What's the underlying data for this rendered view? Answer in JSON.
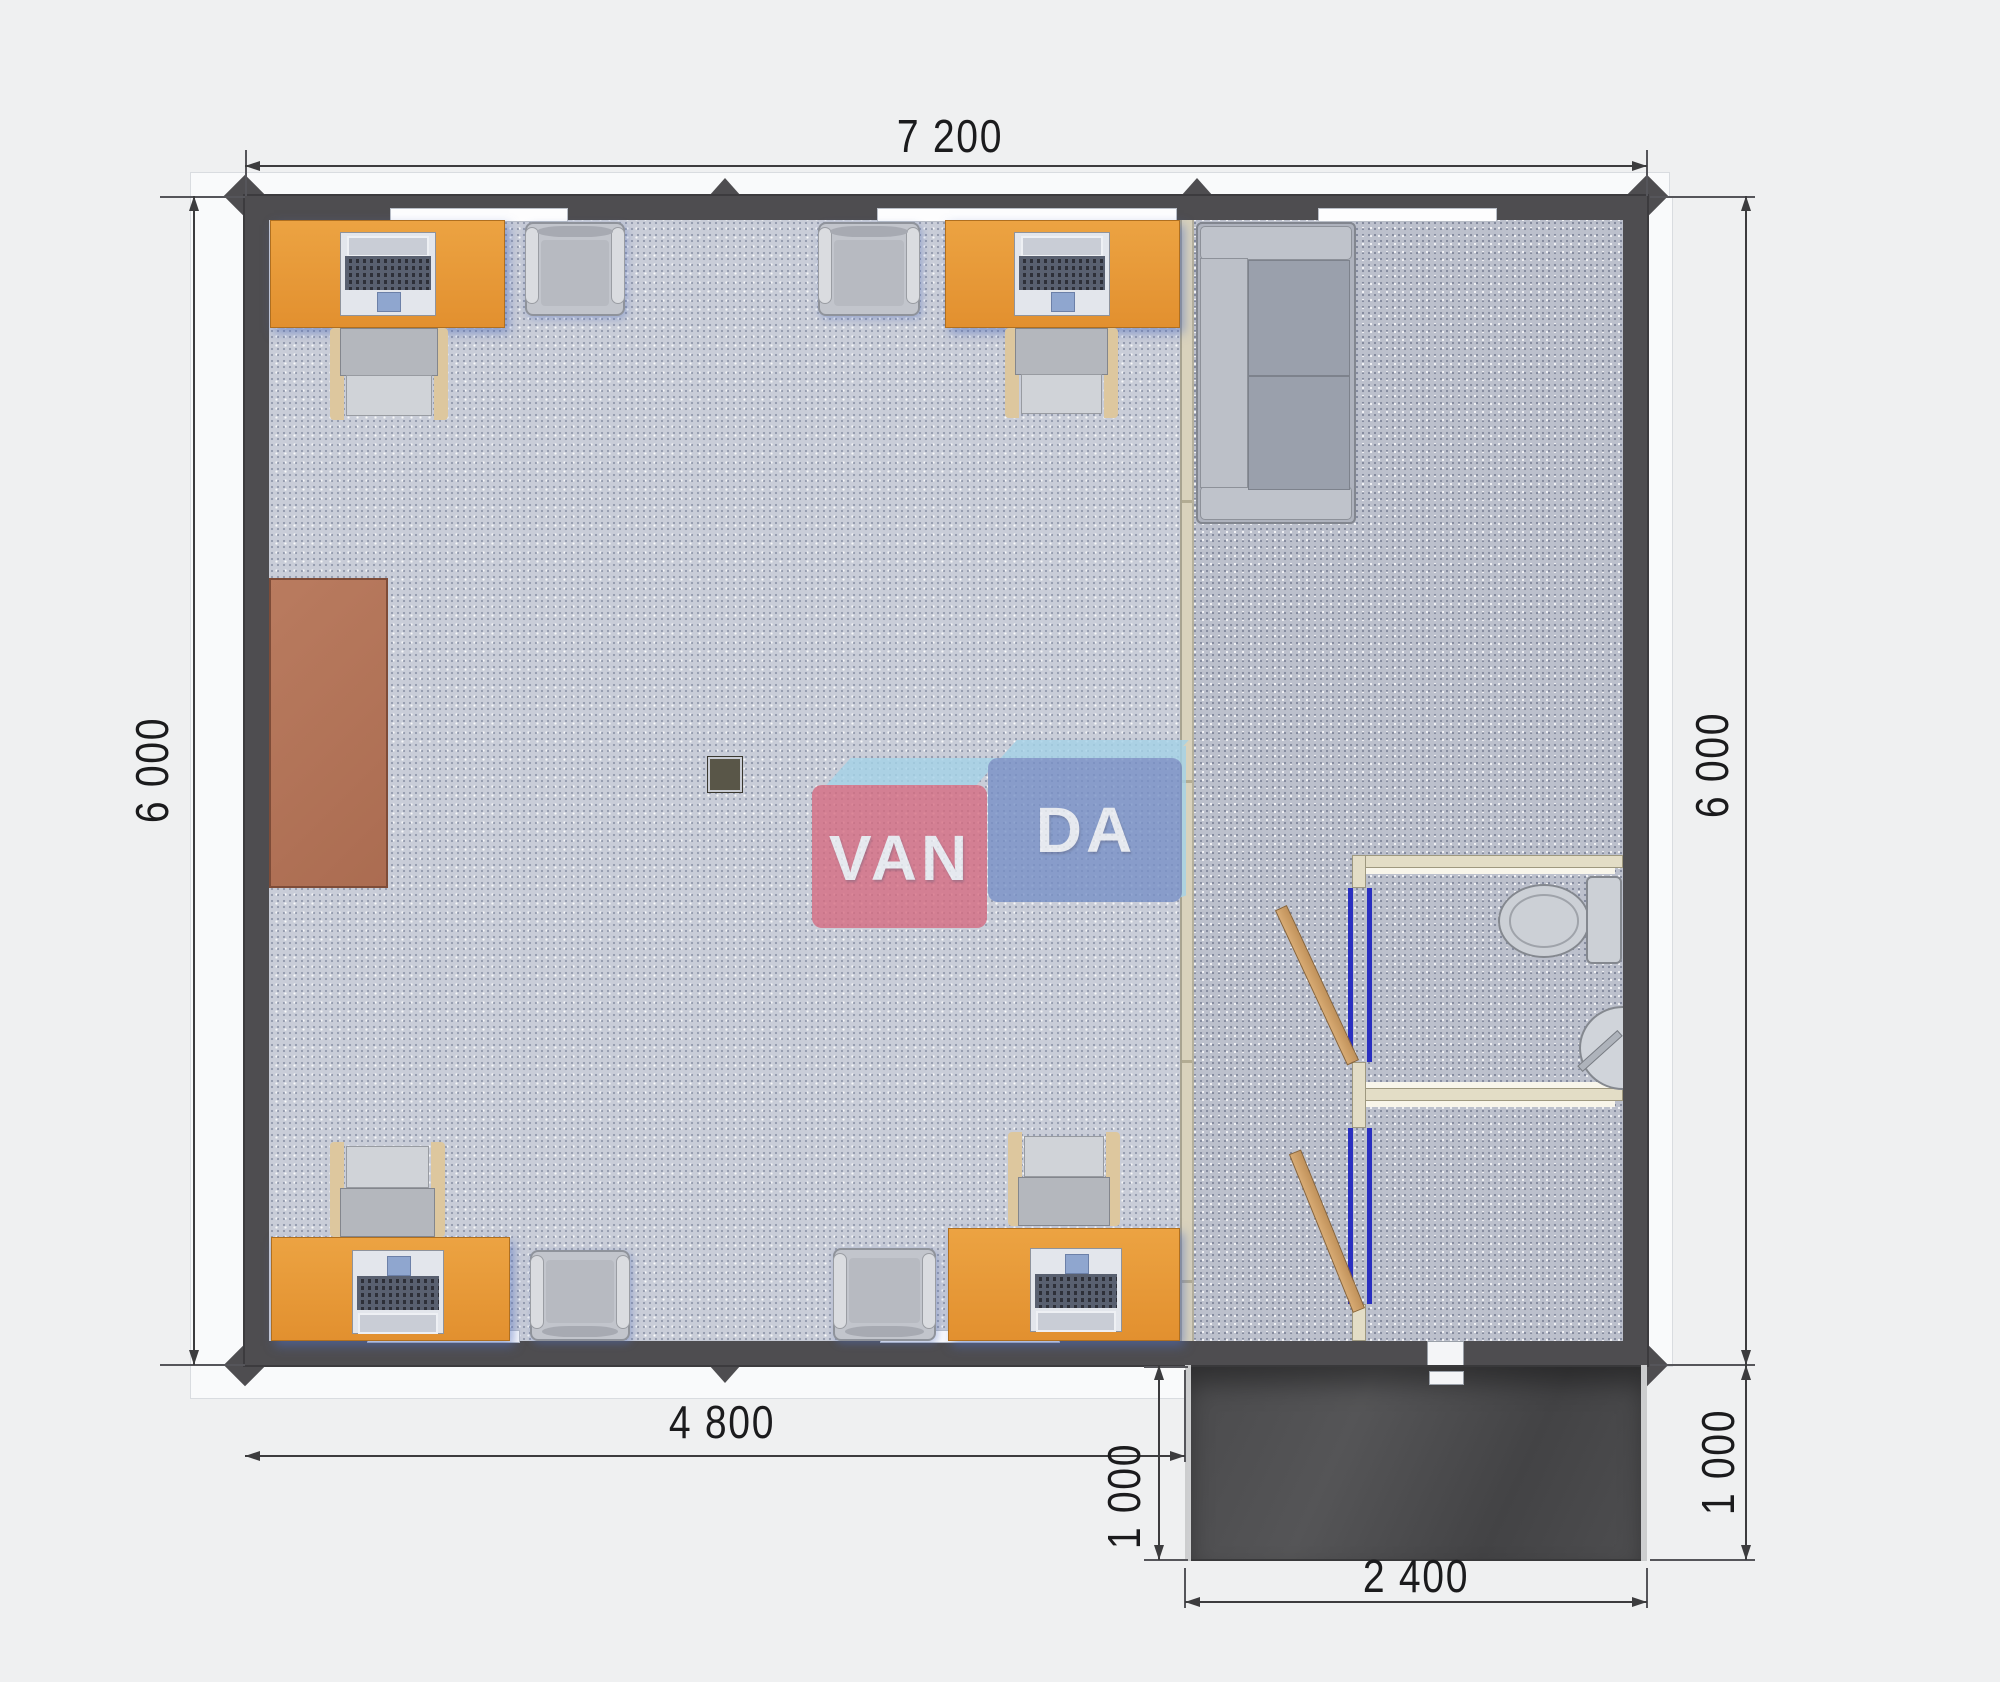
{
  "plan": {
    "dimensions": {
      "total_width_mm": "7 200",
      "left_height_mm": "6 000",
      "right_height_mm": "6 000",
      "main_width_mm": "4 800",
      "porch_depth_left_mm": "1 000",
      "porch_depth_right_mm": "1 000",
      "porch_width_mm": "2 400"
    },
    "watermark": {
      "part1": "VAN",
      "part2": "DA"
    },
    "colors": {
      "wall": "#4e4d50",
      "desk_orange": "#e79a3c",
      "cabinet_brown": "#b07458",
      "floor_left": "#c9cdd8",
      "floor_right": "#bcc0cc",
      "partition_beige": "#d9d2bc",
      "door_jamb_blue": "#2a2fc0",
      "door_wood": "#cd9f6b",
      "porch": "#4a4a4c",
      "logo_pink": "#d66c82",
      "logo_blue": "#7891c7",
      "logo_light_blue": "#a4d2e8",
      "dimension_text": "#1b1b1d"
    }
  }
}
